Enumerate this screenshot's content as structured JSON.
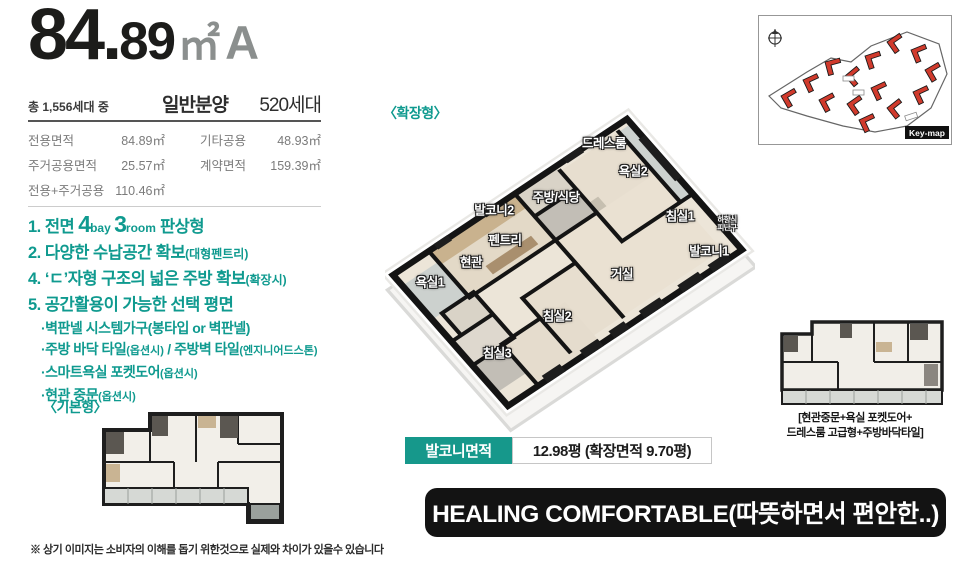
{
  "colors": {
    "accent_teal": "#16988b",
    "feature_teal": "#0f9a8f",
    "banner_bg": "#131313",
    "keymap_red": "#d03a2c"
  },
  "title": {
    "num_big": "84.",
    "num_small": "89",
    "unit": "㎡",
    "type": "A"
  },
  "summary": {
    "total_label": "총 1,556세대 중",
    "sale_label": "일반분양",
    "units_label": "520세대"
  },
  "area_table": {
    "rows": [
      {
        "c1": "전용면적",
        "v1": "84.89㎡",
        "c2": "기타공용",
        "v2": "48.93㎡"
      },
      {
        "c1": "주거공용면적",
        "v1": "25.57㎡",
        "c2": "계약면적",
        "v2": "159.39㎡"
      },
      {
        "c1": "전용+주거공용",
        "v1": "110.46㎡",
        "c2": "",
        "v2": ""
      }
    ]
  },
  "features": {
    "items": [
      {
        "segments": [
          {
            "t": "1. 전면 "
          },
          {
            "t": "4"
          },
          {
            "t": "bay "
          },
          {
            "t": "3"
          },
          {
            "t": "room"
          },
          {
            "t": " 판상형"
          }
        ]
      },
      {
        "segments": [
          {
            "t": "2. 다양한 수납공간 확보"
          },
          {
            "t": "(대형펜트리)"
          }
        ]
      },
      {
        "segments": [
          {
            "t": "4. ‘ㄷ’자형 구조의 넓은 주방 확보"
          },
          {
            "t": "(확장시)"
          }
        ]
      },
      {
        "segments": [
          {
            "t": "5. 공간활용이 가능한 선택 평면"
          }
        ]
      }
    ],
    "subitems": [
      {
        "segments": [
          {
            "t": "·벽판넬 시스템가구(봉타입 or 벽판넬)"
          }
        ]
      },
      {
        "segments": [
          {
            "t": "·주방 바닥 타일"
          },
          {
            "t": "(옵션시)"
          },
          {
            "t": " / 주방벽 타일"
          },
          {
            "t": "(엔지니어드스톤)"
          }
        ]
      },
      {
        "segments": [
          {
            "t": "·스마트욕실 포켓도어"
          },
          {
            "t": "(옵션시)"
          }
        ]
      },
      {
        "segments": [
          {
            "t": "·현관 중문"
          },
          {
            "t": "(옵션시)"
          }
        ]
      }
    ]
  },
  "plan_main": {
    "label": "〈확장형〉",
    "rooms": {
      "dress": "드레스룸",
      "bath2": "욕실2",
      "kitchen": "주방/식당",
      "balcony2": "발코니2",
      "bed1": "침실1",
      "pantry": "펜트리",
      "escape_line1": "하향식",
      "escape_line2": "피난구",
      "balcony1": "발코니1",
      "entrance": "현관",
      "bath1": "욕실1",
      "living": "거실",
      "bed2": "침실2",
      "bed3": "침실3"
    }
  },
  "plan_basic": {
    "label": "〈기본형〉"
  },
  "keymap": {
    "label": "Key-map",
    "compass_icon": "compass"
  },
  "balcony_info": {
    "label": "발코니면적",
    "value": "12.98평 (확장면적 9.70평)"
  },
  "option_caption": {
    "line1": "[현관중문+욕실 포켓도어+",
    "line2": "드레스룸 고급형+주방바닥타일]"
  },
  "banner": {
    "text": "HEALING COMFORTABLE(따뜻하면서 편안한..)"
  },
  "footnote": "※ 상기 이미지는 소비자의 이해를 돕기 위한것으로 실제와 차이가 있을수 있습니다"
}
